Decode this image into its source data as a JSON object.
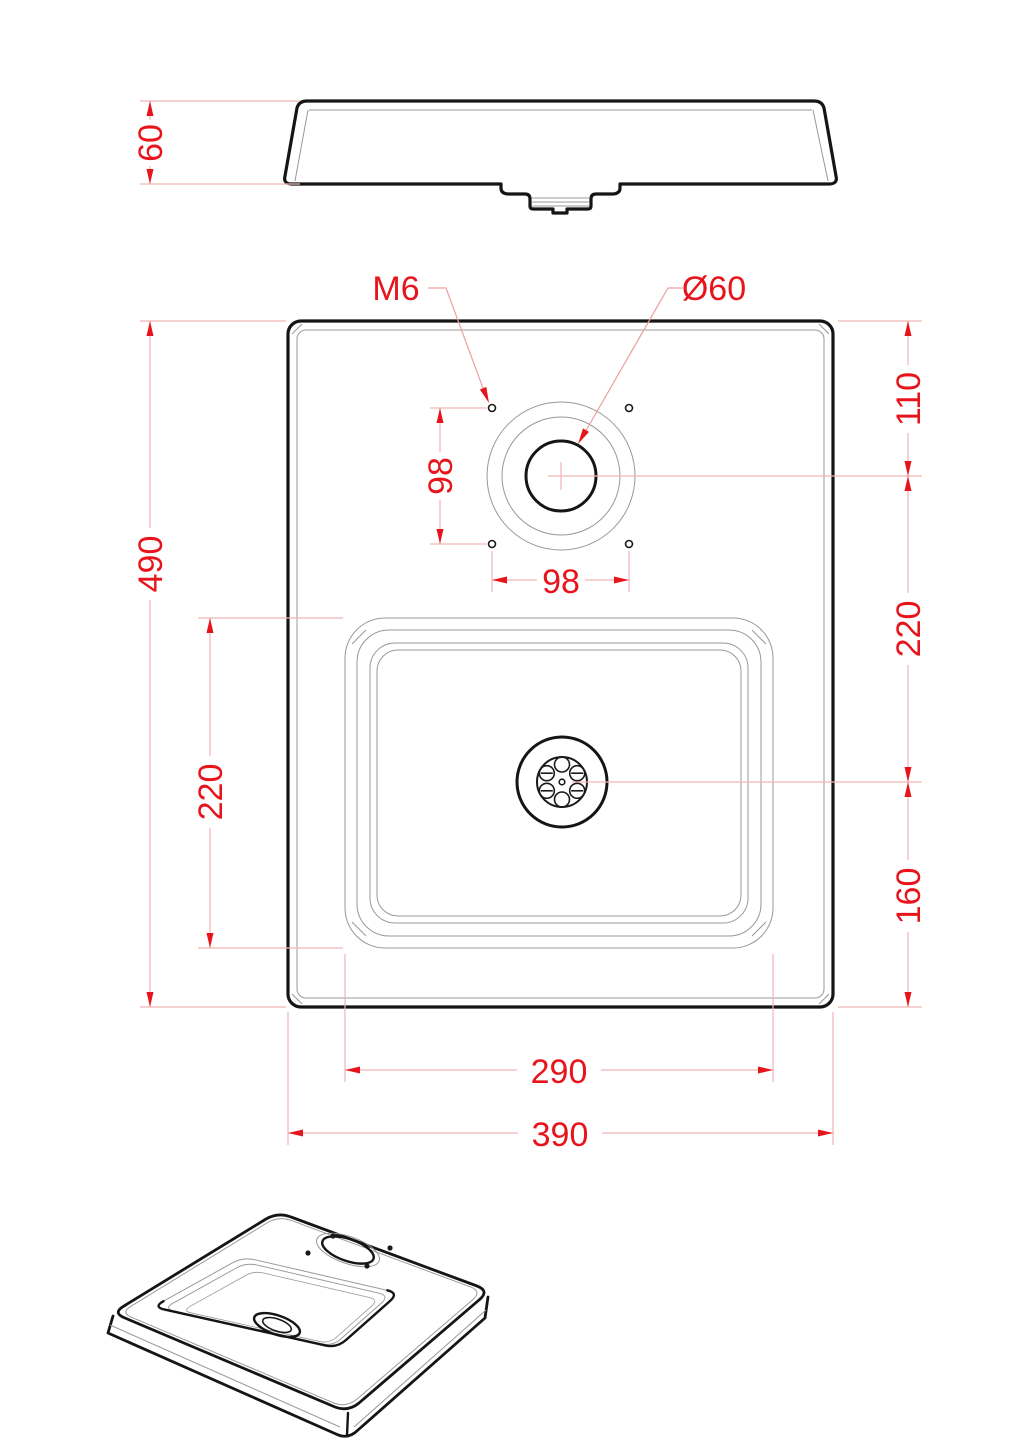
{
  "drawing": {
    "kind": "sink technical drawing, three views (side, plan, isometric)",
    "dims": {
      "side_height": "60",
      "overall_height": "490",
      "basin_height": "220",
      "top_to_faucet": "110",
      "faucet_to_drain": "220",
      "drain_to_bottom": "160",
      "hole_spacing_v": "98",
      "hole_spacing_h": "98",
      "basin_width": "290",
      "overall_width": "390"
    },
    "labels": {
      "thread": "M6",
      "faucet_diameter": "Ø60"
    },
    "colors": {
      "dimension_accent": "#e8141c",
      "dimension_line": "#f2b4b4",
      "outline_bold": "#151515",
      "outline_thin": "#989898",
      "background": "#ffffff"
    }
  }
}
